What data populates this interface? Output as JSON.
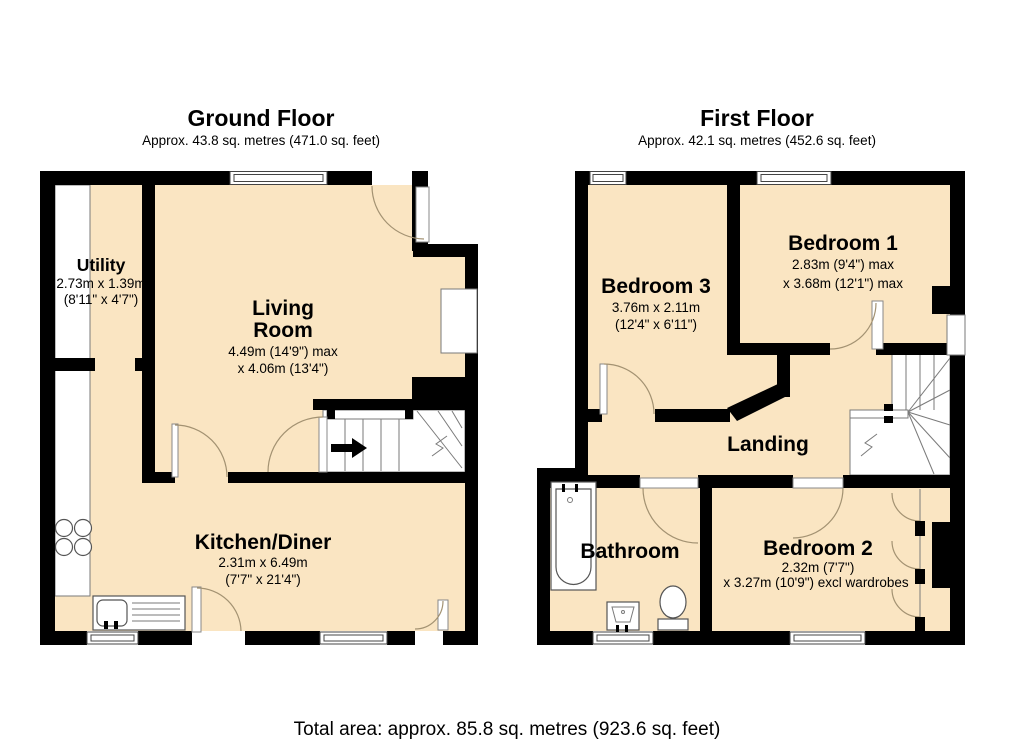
{
  "ground_floor": {
    "title": "Ground Floor",
    "subtitle": "Approx. 43.8 sq. metres (471.0 sq. feet)",
    "rooms": {
      "utility": {
        "name": "Utility",
        "dim1": "2.73m x 1.39m",
        "dim2": "(8'11\" x 4'7\")"
      },
      "living": {
        "name1": "Living",
        "name2": "Room",
        "dim1": "4.49m (14'9\") max",
        "dim2": "x 4.06m (13'4\")"
      },
      "kitchen": {
        "name": "Kitchen/Diner",
        "dim1": "2.31m x 6.49m",
        "dim2": "(7'7\" x 21'4\")"
      }
    }
  },
  "first_floor": {
    "title": "First Floor",
    "subtitle": "Approx. 42.1 sq. metres (452.6 sq. feet)",
    "rooms": {
      "bedroom3": {
        "name": "Bedroom 3",
        "dim1": "3.76m x 2.11m",
        "dim2": "(12'4\" x 6'11\")"
      },
      "bedroom1": {
        "name": "Bedroom 1",
        "dim1": "2.83m (9'4\") max",
        "dim2": "x 3.68m (12'1\") max"
      },
      "bedroom2": {
        "name": "Bedroom 2",
        "dim1": "2.32m (7'7\")",
        "dim2": "x 3.27m (10'9\") excl wardrobes"
      },
      "bathroom": {
        "name": "Bathroom"
      },
      "landing": {
        "name": "Landing"
      }
    }
  },
  "footer": {
    "total": "Total area: approx. 85.8 sq. metres (923.6 sq. feet)"
  },
  "colors": {
    "floor": "#FAE5C2",
    "wall": "#000000",
    "door_arc": "#A39272",
    "fixture_line": "#555555"
  },
  "icons": [
    "stairs-up-arrow-icon",
    "bath-icon",
    "toilet-icon",
    "basin-icon",
    "hob-icon",
    "sink-icon",
    "window-icon",
    "door-arc-icon"
  ]
}
